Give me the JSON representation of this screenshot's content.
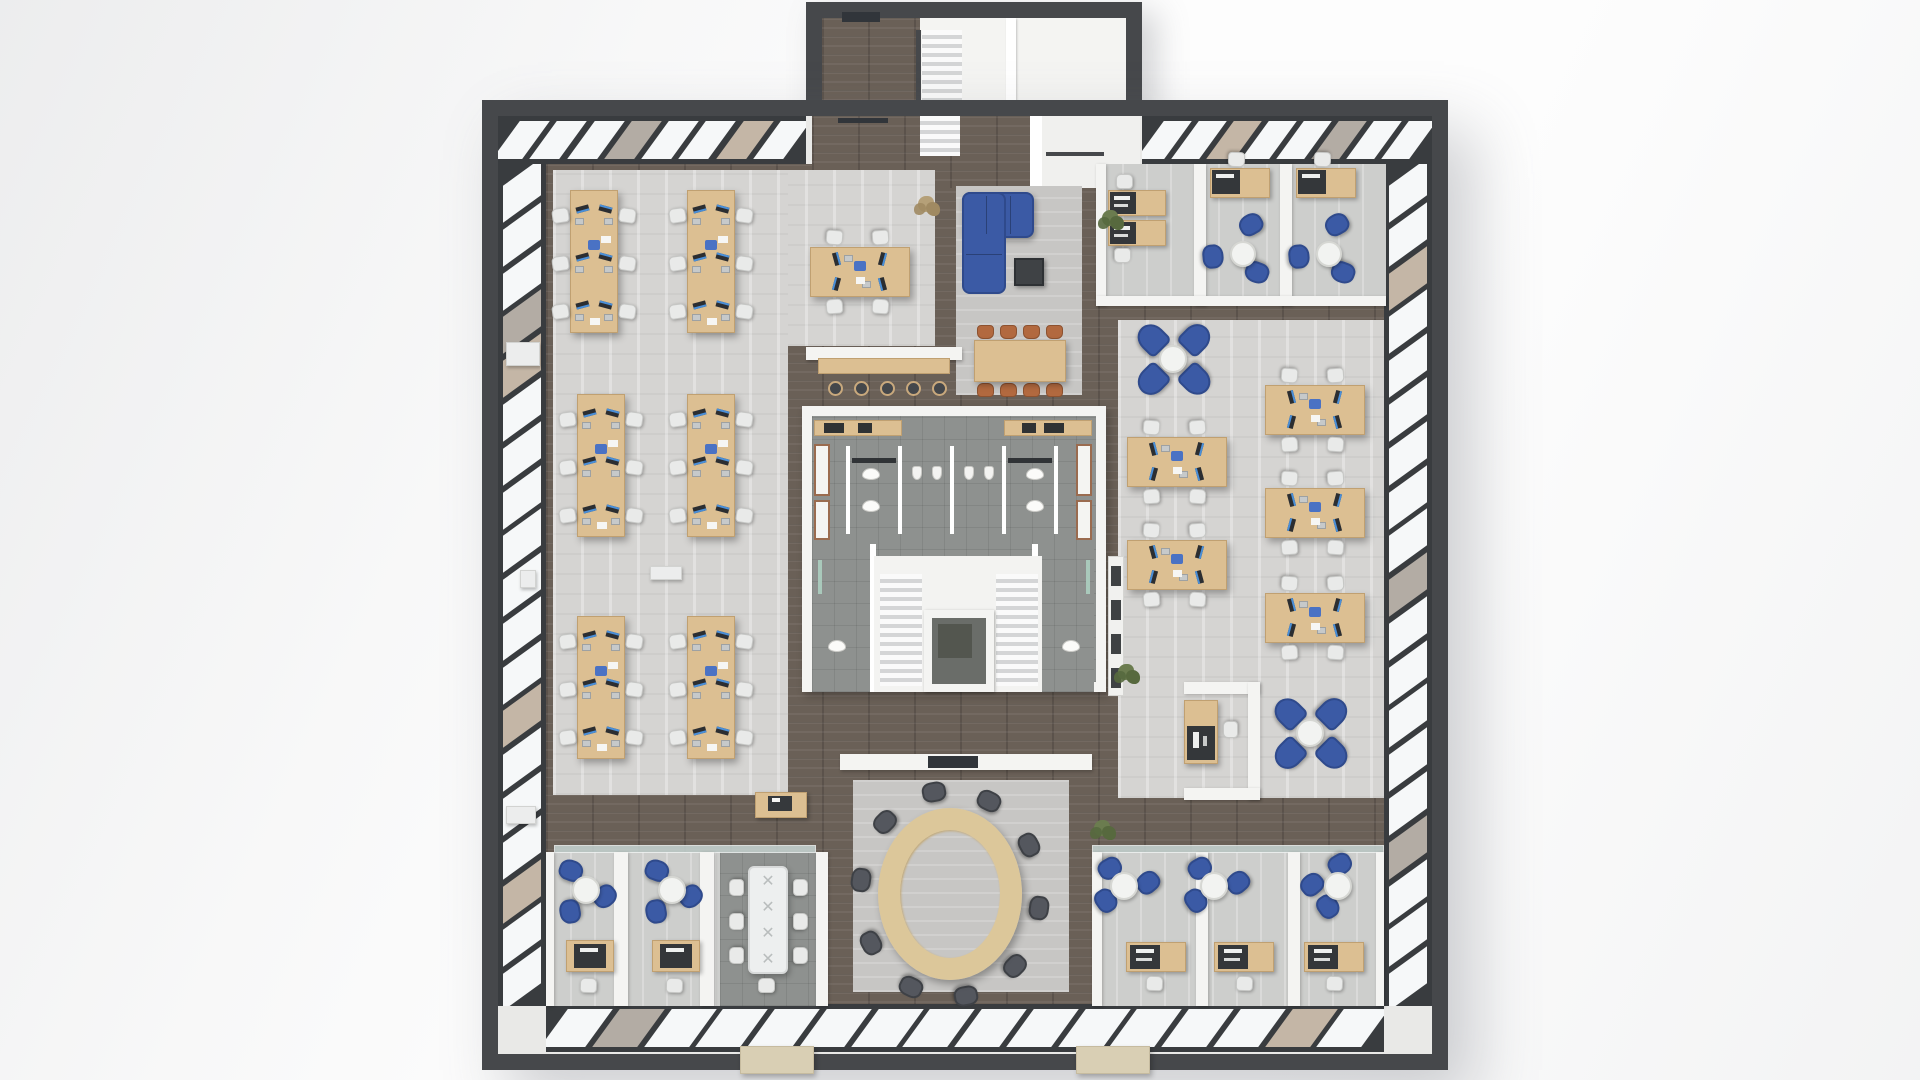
{
  "palette": {
    "wall_dark": "#46484b",
    "wall_white": "#f4f4f2",
    "wall_white_edge": "#dcdcd8",
    "glass": "#c9d7d5",
    "glass_door": "#31353a",
    "pane_white": "#f6f8f9",
    "pane_tan": "#c4b6a6",
    "pane_gray": "#b3aca4",
    "band_dark": "#393c3f",
    "desk_wood": "#dcbf92",
    "desk_wood_edge": "#c0a071",
    "chair_white": "#e9eae9",
    "chair_white_border": "#c6c7c5",
    "chair_blue": "#3b5aa5",
    "chair_blue_dark": "#2f4a8c",
    "chair_orange": "#b2693f",
    "chair_oval": "#54575e",
    "chair_oval_edge": "#3e4146",
    "monitor": "#2c2e31",
    "screen": "#4a8fd8",
    "laptop": "#c6c9ca",
    "pad_blue": "#4a72c4",
    "table_white": "#f2f3f1",
    "table_white_edge": "#d6d7d3",
    "coffee_dark": "#3f4245",
    "stool_dark": "#44474b",
    "stool_rim": "#c9a97d",
    "oval_wood": "#dcc79a",
    "oval_wood_edge": "#c3a873",
    "mat_beige": "#d9cfb4",
    "plant_green": "#6b7c4f",
    "plant_green2": "#57693e",
    "plant_dry": "#b5a078",
    "cabinet_trim": "#9a6b4f",
    "elevator_in": "#6a6d69",
    "elevator_sq": "#53564f",
    "paper": "#f6f6f4"
  },
  "scene": {
    "frame": [
      482,
      100,
      966,
      970
    ],
    "wall_t": 16,
    "protrusion": {
      "outer": [
        806,
        2,
        336,
        120
      ],
      "interior": [
        822,
        18,
        304,
        88
      ],
      "wood": [
        822,
        18,
        98,
        88
      ],
      "door": [
        842,
        12,
        38,
        10
      ],
      "divider": [
        1006,
        18,
        10,
        88
      ],
      "stairs": [
        922,
        30,
        40,
        78
      ],
      "rail": [
        916,
        30,
        5,
        78
      ]
    },
    "window_bands": [
      {
        "r": [
          498,
          116,
          308,
          48
        ],
        "dir": "h",
        "n": 8,
        "tan": [
          3,
          6
        ]
      },
      {
        "r": [
          1142,
          116,
          290,
          48
        ],
        "dir": "h",
        "n": 8,
        "tan": [
          2,
          5
        ]
      },
      {
        "r": [
          498,
          164,
          48,
          842
        ],
        "dir": "v",
        "n": 19,
        "tan": [
          3,
          4,
          12,
          16
        ]
      },
      {
        "r": [
          1384,
          164,
          48,
          842
        ],
        "dir": "v",
        "n": 19,
        "tan": [
          2,
          9,
          15
        ]
      },
      {
        "r": [
          546,
          1004,
          838,
          48
        ],
        "dir": "h",
        "n": 16,
        "tan": [
          1,
          14
        ]
      }
    ],
    "base_floor": [
      546,
      164,
      838,
      840
    ],
    "vestibule": {
      "wood": [
        812,
        116,
        218,
        72
      ],
      "glass_door": [
        838,
        118,
        50,
        5
      ],
      "wall": [
        1030,
        116,
        12,
        72
      ],
      "lobby": [
        1042,
        116,
        98,
        72
      ],
      "stair": [
        920,
        116,
        40,
        40
      ],
      "rail": [
        1046,
        152,
        58,
        4
      ]
    },
    "floors": [
      {
        "r": [
          553,
          170,
          382,
          176
        ],
        "k": "carpet",
        "name": "open-office-left-carpet-top"
      },
      {
        "r": [
          553,
          170,
          235,
          625
        ],
        "k": "carpet",
        "name": "open-office-left-carpet"
      },
      {
        "r": [
          956,
          186,
          126,
          209
        ],
        "k": "rug",
        "name": "breakout-rug"
      },
      {
        "r": [
          1098,
          164,
          288,
          134
        ],
        "k": "ofloor",
        "name": "top-right-offices-floor"
      },
      {
        "r": [
          1118,
          320,
          266,
          478
        ],
        "k": "carpet",
        "name": "open-office-right-carpet"
      },
      {
        "r": [
          853,
          780,
          216,
          212
        ],
        "k": "rug",
        "name": "oval-room-rug"
      },
      {
        "r": [
          546,
          852,
          176,
          154
        ],
        "k": "ofloor",
        "name": "bottom-left-offices-floor"
      },
      {
        "r": [
          720,
          852,
          96,
          154
        ],
        "k": "tile",
        "name": "bottom-left-conference-floor"
      },
      {
        "r": [
          1092,
          852,
          292,
          154
        ],
        "k": "ofloor",
        "name": "bottom-right-offices-floor"
      }
    ],
    "core": {
      "outer": [
        802,
        406,
        304,
        286
      ],
      "tile": [
        812,
        416,
        284,
        266
      ],
      "counters": [
        [
          814,
          420,
          88,
          16
        ],
        [
          1004,
          420,
          88,
          16
        ]
      ],
      "counter_marks": [
        [
          824,
          423,
          20,
          10
        ],
        [
          858,
          423,
          14,
          10
        ],
        [
          1022,
          423,
          14,
          10
        ],
        [
          1044,
          423,
          20,
          10
        ]
      ],
      "lockers": [
        [
          814,
          444,
          16,
          52
        ],
        [
          814,
          500,
          16,
          40
        ],
        [
          1076,
          444,
          16,
          52
        ],
        [
          1076,
          500,
          16,
          40
        ]
      ],
      "stall_walls": [
        846,
        898,
        950,
        1002,
        1054
      ],
      "stall_wall_y": 446,
      "stall_wall_h": 88,
      "dark_bars": [
        [
          852,
          458,
          44,
          5
        ],
        [
          1008,
          458,
          44,
          5
        ]
      ],
      "toilets": [
        [
          862,
          468
        ],
        [
          862,
          500
        ],
        [
          1026,
          468
        ],
        [
          1026,
          500
        ]
      ],
      "urinals": [
        [
          912,
          466
        ],
        [
          932,
          466
        ],
        [
          964,
          466
        ],
        [
          984,
          466
        ]
      ],
      "sinks": [
        [
          896,
          556,
          50,
          16
        ],
        [
          962,
          556,
          50,
          16
        ]
      ],
      "corner_rooms": [
        [
          812,
          544,
          62,
          148
        ],
        [
          1032,
          544,
          62,
          148
        ]
      ],
      "corner_walls": [
        [
          870,
          544,
          6,
          148
        ],
        [
          1032,
          544,
          6,
          148
        ]
      ],
      "corner_glass": [
        [
          818,
          560,
          4,
          34
        ],
        [
          1086,
          560,
          4,
          34
        ]
      ],
      "corner_toilets": [
        [
          828,
          640
        ],
        [
          1062,
          640
        ]
      ],
      "stair_bg": [
        874,
        556,
        168,
        136
      ],
      "stairs": [
        [
          880,
          574,
          42,
          112
        ],
        [
          996,
          574,
          42,
          112
        ]
      ],
      "elevator": {
        "frame": [
          924,
          610,
          70,
          82
        ],
        "inner": [
          932,
          618,
          54,
          66
        ],
        "sq": [
          938,
          624,
          34,
          34
        ]
      },
      "bottom_wall": [
        840,
        754,
        252,
        16
      ],
      "bottom_door": [
        928,
        756,
        50,
        12
      ]
    },
    "desk_banks": {
      "w": 48,
      "h": 143,
      "positions": [
        [
          570,
          190
        ],
        [
          687,
          190
        ],
        [
          577,
          394
        ],
        [
          687,
          394
        ],
        [
          577,
          616
        ],
        [
          687,
          616
        ]
      ]
    },
    "desk_islands": {
      "w": 100,
      "h": 50,
      "positions": [
        [
          810,
          247
        ],
        [
          1265,
          385
        ],
        [
          1127,
          437
        ],
        [
          1265,
          488
        ],
        [
          1127,
          540
        ],
        [
          1265,
          593
        ]
      ]
    },
    "pinwheel_tables": [
      [
        1173,
        359
      ],
      [
        1310,
        733
      ]
    ],
    "breakout": {
      "sofa_h": [
        962,
        192,
        72,
        46
      ],
      "sofa_v": [
        962,
        192,
        44,
        102
      ],
      "coffee": [
        1014,
        258,
        30,
        28
      ],
      "dining_table": [
        974,
        340,
        92,
        42
      ],
      "dining_chair_xs": [
        977,
        1000,
        1023,
        1046
      ],
      "dining_top_y": 325,
      "dining_bot_y": 383,
      "bar_wall": [
        806,
        347,
        156,
        13
      ],
      "bar_counter": [
        818,
        358,
        132,
        16
      ],
      "stool_xs": [
        828,
        854,
        880,
        906,
        932
      ],
      "stool_y": 381
    },
    "tr_offices": {
      "walls": [
        [
          1096,
          164,
          10,
          142
        ],
        [
          1194,
          164,
          12,
          142
        ],
        [
          1280,
          164,
          12,
          142
        ],
        [
          1096,
          296,
          290,
          10
        ]
      ],
      "desks2": [
        [
          1108,
          190,
          58,
          26
        ],
        [
          1108,
          220,
          58,
          26
        ]
      ],
      "desk2_chairs": [
        [
          1116,
          174,
          0
        ],
        [
          1114,
          248,
          180
        ]
      ],
      "lounge_rooms": [
        {
          "desk": [
            1210,
            168,
            60,
            30
          ],
          "chair": [
            1228,
            152
          ],
          "table": [
            1243,
            254
          ],
          "blues": [
            [
              8,
              -30
            ],
            [
              -30,
              2
            ],
            [
              14,
              18
            ]
          ]
        },
        {
          "desk": [
            1296,
            168,
            60,
            30
          ],
          "chair": [
            1314,
            152
          ],
          "table": [
            1329,
            254
          ],
          "blues": [
            [
              8,
              -30
            ],
            [
              -30,
              2
            ],
            [
              14,
              18
            ]
          ]
        }
      ]
    },
    "bl_offices": {
      "walls": [
        [
          546,
          852,
          8,
          154
        ],
        [
          614,
          852,
          14,
          154
        ],
        [
          700,
          852,
          14,
          154
        ],
        [
          816,
          852,
          12,
          154
        ]
      ],
      "glass": [
        554,
        845,
        262,
        8
      ],
      "rooms": [
        {
          "table": [
            586,
            890
          ],
          "blues": [
            [
              -15,
              -20
            ],
            [
              19,
              6
            ],
            [
              -16,
              21
            ]
          ],
          "desk": [
            566,
            940,
            48,
            32
          ],
          "chair": [
            580,
            978
          ]
        },
        {
          "table": [
            672,
            890
          ],
          "blues": [
            [
              -15,
              -20
            ],
            [
              19,
              6
            ],
            [
              -16,
              21
            ]
          ],
          "desk": [
            652,
            940,
            48,
            32
          ],
          "chair": [
            666,
            978
          ]
        }
      ],
      "conf_table": [
        748,
        866,
        40,
        108
      ],
      "conf_chair_l_x": 728,
      "conf_chair_r_x": 792,
      "conf_chair_ys": [
        880,
        914,
        948
      ],
      "conf_chair_b": [
        758,
        978
      ]
    },
    "br_offices": {
      "walls": [
        [
          1092,
          852,
          10,
          154
        ],
        [
          1196,
          852,
          12,
          154
        ],
        [
          1288,
          852,
          12,
          154
        ],
        [
          1376,
          852,
          8,
          154
        ]
      ],
      "glass": [
        1092,
        845,
        292,
        8
      ],
      "rooms": [
        {
          "table": [
            1124,
            886
          ],
          "blues": [
            [
              24,
              -4
            ],
            [
              -18,
              14
            ],
            [
              -14,
              -18
            ]
          ],
          "desk": [
            1126,
            942,
            60,
            30
          ],
          "chair": [
            1146,
            976
          ]
        },
        {
          "table": [
            1214,
            886
          ],
          "blues": [
            [
              24,
              -4
            ],
            [
              -18,
              14
            ],
            [
              -14,
              -18
            ]
          ],
          "desk": [
            1214,
            942,
            60,
            30
          ],
          "chair": [
            1236,
            976
          ]
        },
        {
          "table": [
            1338,
            886
          ],
          "blues": [
            [
              -26,
              -2
            ],
            [
              -10,
              20
            ],
            [
              2,
              -22
            ]
          ],
          "desk": [
            1304,
            942,
            60,
            30
          ],
          "chair": [
            1326,
            976
          ]
        }
      ]
    },
    "oval": {
      "cx": 950,
      "cy": 894,
      "rx": 72,
      "ry": 86,
      "ring": 22,
      "chairs": 10
    },
    "reception": {
      "walls": [
        [
          1184,
          682,
          76,
          12
        ],
        [
          1248,
          682,
          12,
          118
        ],
        [
          1184,
          788,
          76,
          12
        ]
      ],
      "desk": [
        1184,
        700,
        34,
        64
      ],
      "panel": [
        1187,
        726,
        28,
        34
      ],
      "chair": [
        1222,
        722
      ]
    },
    "storage_cabinet": [
      1108,
      556,
      16,
      140
    ],
    "printer_desk": {
      "desk": [
        755,
        792,
        52,
        26
      ],
      "printer": [
        768,
        796,
        24,
        15
      ],
      "paper": [
        772,
        798,
        8,
        4
      ]
    },
    "white_boxes": [
      [
        506,
        342,
        34,
        24
      ],
      [
        520,
        570,
        16,
        18
      ],
      [
        506,
        806,
        30,
        18
      ],
      [
        650,
        566,
        32,
        14
      ]
    ],
    "plants": [
      {
        "p": [
          918,
          196
        ],
        "t": "dry"
      },
      {
        "p": [
          1102,
          210
        ],
        "t": "green"
      },
      {
        "p": [
          1118,
          664
        ],
        "t": "green"
      },
      {
        "p": [
          1094,
          820
        ],
        "t": "green"
      }
    ],
    "entry_mats": [
      [
        740,
        1046,
        74,
        28
      ],
      [
        1076,
        1046,
        74,
        28
      ]
    ]
  }
}
